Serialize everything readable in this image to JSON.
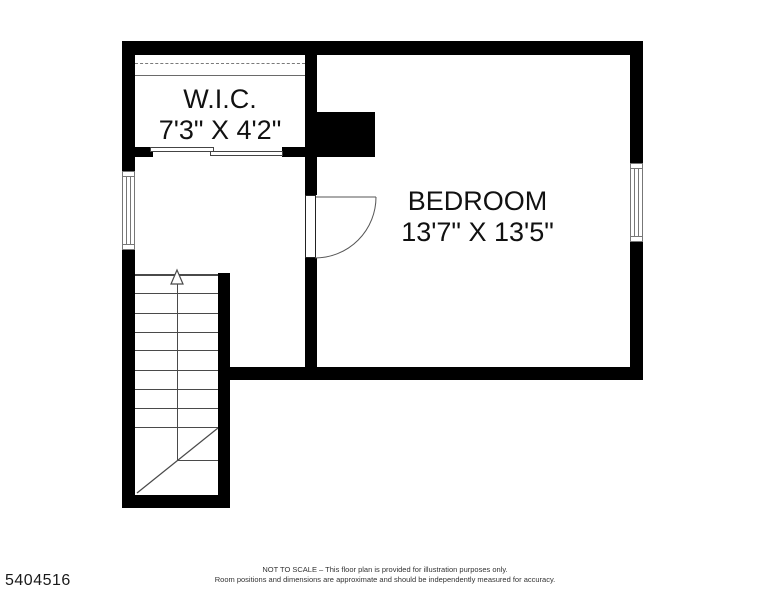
{
  "floor_plan": {
    "wic": {
      "name": "W.I.C.",
      "dimensions": "7'3\" X 4'2\""
    },
    "bedroom": {
      "name": "BEDROOM",
      "dimensions": "13'7\" X 13'5\""
    },
    "stairs": {
      "direction": "up",
      "arrow_icon": "up-arrow-triangle"
    },
    "features": {
      "wic_door": "sliding-bypass-doors",
      "bedroom_door": "hinged-door-with-swing-arc",
      "windows": [
        "left-wall-window",
        "right-wall-window"
      ]
    }
  },
  "footer": {
    "mls_number": "5404516",
    "disclaimer_line1": "NOT TO SCALE – This floor plan is provided for illustration purposes only.",
    "disclaimer_line2": "Room positions and dimensions are approximate and should be independently measured for accuracy."
  },
  "colors": {
    "wall": "#000000",
    "thin_line": "#4a4a4a",
    "background": "#ffffff",
    "text": "#111111"
  }
}
